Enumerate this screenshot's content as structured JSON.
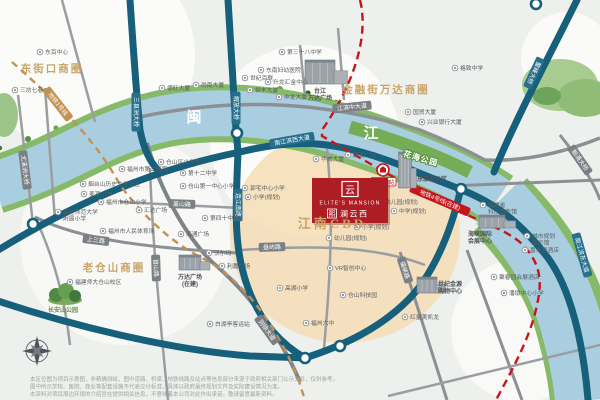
{
  "project": {
    "name_en": "ELITE'S MANSION",
    "prefix": "熙",
    "name_cn": "澜云西",
    "glyph": "云"
  },
  "metro": {
    "station": "江边村站"
  },
  "colors": {
    "logo_red": "#ae1d24",
    "gold_text": "#c9a468",
    "road_teal": "#16607c",
    "road_grey": "#7b8084",
    "river_blue": "#a9cee0",
    "metro_gold": "#c09355",
    "metro_red": "#c5161d",
    "planning_beige": "#f4ddb5"
  },
  "districts": [
    {
      "t": "东街口商圈",
      "x": 52,
      "y": 72,
      "s": 10.5,
      "c": "#c9a468",
      "ls": 2,
      "serif": 1
    },
    {
      "t": "金融街万达商圈",
      "x": 386,
      "y": 93,
      "s": 10.5,
      "c": "#c9a468",
      "ls": 2,
      "serif": 1
    },
    {
      "t": "老仓山商圈",
      "x": 114,
      "y": 271,
      "s": 10.5,
      "c": "#c9a468",
      "ls": 2,
      "serif": 1
    },
    {
      "t": "江南CBD",
      "x": 332,
      "y": 228,
      "s": 13,
      "c": "#c9a468",
      "ls": 3,
      "serif": 1
    },
    {
      "t": "闽",
      "x": 194,
      "y": 122,
      "s": 15,
      "c": "#ffffff",
      "ls": 0,
      "serif": 1
    },
    {
      "t": "江",
      "x": 371,
      "y": 138,
      "s": 15,
      "c": "#ffffff",
      "ls": 0,
      "serif": 1
    },
    {
      "t": "花海公园",
      "x": 420,
      "y": 161,
      "s": 8,
      "c": "#ffffff",
      "ls": 1,
      "rot": 16,
      "halo": "#58923f"
    },
    {
      "t": "长安山公园",
      "x": 63,
      "y": 312,
      "s": 6,
      "c": "#6a8f55",
      "ls": 0
    }
  ],
  "road_labels": [
    {
      "t": "南江滨西大道",
      "x": 292,
      "y": 140,
      "rot": -10,
      "type": "teal"
    },
    {
      "t": "江滨中大道",
      "x": 352,
      "y": 107,
      "rot": -6,
      "type": "grey"
    },
    {
      "t": "三县洲大桥",
      "x": 136,
      "y": 112,
      "rot": 90,
      "type": "teal"
    },
    {
      "t": "解放大桥",
      "x": 236,
      "y": 108,
      "rot": 90,
      "type": "teal"
    },
    {
      "t": "鳌峰大桥",
      "x": 534,
      "y": 73,
      "rot": 115,
      "type": "teal"
    },
    {
      "t": "魁浦大桥",
      "x": 580,
      "y": 160,
      "rot": 55,
      "type": "grey"
    },
    {
      "t": "南江滨东大道",
      "x": 582,
      "y": 255,
      "rot": 74,
      "type": "teal"
    },
    {
      "t": "连江南路",
      "x": 238,
      "y": 205,
      "rot": 90,
      "type": "teal"
    },
    {
      "t": "上三路",
      "x": 96,
      "y": 240,
      "rot": 7,
      "type": "grey"
    },
    {
      "t": "首山路",
      "x": 156,
      "y": 268,
      "rot": 88,
      "type": "grey"
    },
    {
      "t": "则徐大道",
      "x": 267,
      "y": 330,
      "rot": 54,
      "type": "grey"
    },
    {
      "t": "福峡路",
      "x": 405,
      "y": 270,
      "rot": 72,
      "type": "grey"
    },
    {
      "t": "盖山路",
      "x": 182,
      "y": 204,
      "rot": 2,
      "type": "grey"
    },
    {
      "t": "盘屿路",
      "x": 272,
      "y": 247,
      "rot": -2,
      "type": "grey"
    },
    {
      "t": "尤溪洲大桥",
      "x": 25,
      "y": 170,
      "rot": 83,
      "type": "grey"
    },
    {
      "t": "地铁1号线",
      "x": 58,
      "y": 104,
      "rot": 52,
      "type": "gold"
    },
    {
      "t": "地铁4号线(在建)",
      "x": 440,
      "y": 200,
      "rot": 23,
      "type": "red"
    }
  ],
  "buildings": [
    {
      "x": 320,
      "y": 84,
      "w": 30,
      "h": 24,
      "lx": 320,
      "ly": 93,
      "lines": [
        "台江",
        "万达广场"
      ]
    },
    {
      "x": 405,
      "y": 188,
      "w": 13,
      "h": 36,
      "lx": 432,
      "ly": 181,
      "lines": [
        "东部办公区"
      ]
    },
    {
      "x": 190,
      "y": 270,
      "w": 22,
      "h": 15,
      "lx": 190,
      "ly": 279,
      "lines": [
        "万达广场",
        "(在建)"
      ]
    },
    {
      "x": 427,
      "y": 293,
      "w": 20,
      "h": 16,
      "lx": 450,
      "ly": 286,
      "lines": [
        "世纪金源",
        "购物中心"
      ]
    },
    {
      "x": 492,
      "y": 228,
      "w": 26,
      "h": 13,
      "lx": 480,
      "ly": 236,
      "lines": [
        "海峡国际",
        "会展中心"
      ]
    }
  ],
  "pois": [
    {
      "x": 40,
      "y": 52,
      "lines": [
        "东百中心"
      ]
    },
    {
      "x": 15,
      "y": 90,
      "lines": [
        "三坊七巷"
      ]
    },
    {
      "x": 162,
      "y": 88,
      "lines": [
        "德旺大厦"
      ]
    },
    {
      "x": 196,
      "y": 85,
      "lines": [
        "尚南大厦"
      ]
    },
    {
      "x": 245,
      "y": 78,
      "lines": [
        "世纪百联"
      ]
    },
    {
      "x": 268,
      "y": 82,
      "lines": [
        "升龙汇金中心"
      ]
    },
    {
      "x": 250,
      "y": 90,
      "lines": [
        "恒丰大厦"
      ]
    },
    {
      "x": 279,
      "y": 97,
      "lines": [
        "申发大厦"
      ]
    },
    {
      "x": 261,
      "y": 70,
      "lines": [
        "东南妇幼医院"
      ]
    },
    {
      "x": 282,
      "y": 52,
      "lines": [
        "第三十八中学"
      ]
    },
    {
      "x": 455,
      "y": 68,
      "lines": [
        "格致中学"
      ]
    },
    {
      "x": 408,
      "y": 112,
      "lines": [
        "国贸大厦"
      ]
    },
    {
      "x": 422,
      "y": 122,
      "lines": [
        "兴业银行大厦"
      ]
    },
    {
      "x": 348,
      "y": 155,
      "lines": [
        "建发广场"
      ]
    },
    {
      "x": 316,
      "y": 159,
      "lines": [
        "华威大厦"
      ]
    },
    {
      "x": 380,
      "y": 202,
      "lines": [
        "幼儿园(规划)"
      ]
    },
    {
      "x": 394,
      "y": 211,
      "lines": [
        "中学(规划)"
      ]
    },
    {
      "x": 357,
      "y": 227,
      "lines": [
        "小学(规划)"
      ]
    },
    {
      "x": 329,
      "y": 238,
      "lines": [
        "幼儿园(规划)"
      ]
    },
    {
      "x": 245,
      "y": 188,
      "lines": [
        "郭宅中心小学"
      ]
    },
    {
      "x": 248,
      "y": 197,
      "lines": [
        "小学(规划)"
      ]
    },
    {
      "x": 161,
      "y": 162,
      "lines": [
        "仓山区少年宫"
      ]
    },
    {
      "x": 183,
      "y": 173,
      "lines": [
        "第十二中学"
      ]
    },
    {
      "x": 183,
      "y": 186,
      "lines": [
        "仓山第一中心小学"
      ]
    },
    {
      "x": 122,
      "y": 169,
      "lines": [
        "福州市第二医院"
      ]
    },
    {
      "x": 83,
      "y": 184,
      "lines": [
        "烟台山历史文化街区"
      ]
    },
    {
      "x": 84,
      "y": 194,
      "lines": [
        "麦顶小学"
      ]
    },
    {
      "x": 101,
      "y": 202,
      "lines": [
        "福州市仓山小学"
      ]
    },
    {
      "x": 58,
      "y": 212,
      "lines": [
        "福建师范大学",
        "附属小学"
      ]
    },
    {
      "x": 139,
      "y": 210,
      "lines": [
        "汇达广场"
      ]
    },
    {
      "x": 103,
      "y": 231,
      "lines": [
        "福州市人民体育场"
      ]
    },
    {
      "x": 181,
      "y": 234,
      "lines": [
        "海通广场"
      ]
    },
    {
      "x": 205,
      "y": 218,
      "lines": [
        "第四十中学"
      ]
    },
    {
      "x": 70,
      "y": 282,
      "lines": [
        "福建师大仓山校区"
      ]
    },
    {
      "x": 210,
      "y": 324,
      "lines": [
        "白湖亭客运站"
      ]
    },
    {
      "x": 209,
      "y": 253,
      "lines": [
        "沃尔玛"
      ]
    },
    {
      "x": 222,
      "y": 266,
      "lines": [
        "利嘉广场"
      ]
    },
    {
      "x": 280,
      "y": 288,
      "lines": [
        "高湖小学"
      ]
    },
    {
      "x": 330,
      "y": 268,
      "lines": [
        "VR智创中心"
      ]
    },
    {
      "x": 343,
      "y": 295,
      "lines": [
        "仓山科技园"
      ]
    },
    {
      "x": 306,
      "y": 323,
      "lines": [
        "福州六中"
      ]
    },
    {
      "x": 405,
      "y": 317,
      "lines": [
        "红星美凯龙"
      ]
    },
    {
      "x": 494,
      "y": 277,
      "lines": [
        "聚春园会展酒店"
      ]
    },
    {
      "x": 504,
      "y": 293,
      "lines": [
        "潘墩中心小学"
      ]
    },
    {
      "x": 483,
      "y": 205,
      "lines": [
        "福建省",
        "科技馆新馆"
      ]
    },
    {
      "x": 527,
      "y": 236,
      "lines": [
        "城市规划",
        "展示馆"
      ]
    },
    {
      "x": 525,
      "y": 250,
      "lines": [
        "喜来登酒店"
      ]
    }
  ],
  "disclaimer": {
    "line1": "本区位图为项目示意图，非精确测绘，图中道路、桥梁、地铁线路及站点等信息部分来源于政府相关部门公示文件，仅供参考。",
    "line2": "图中所示学校、医院、商业等配套设施不代表交付标准，具体以政府最终规划文件及实际建设情况为准。",
    "line3": "本资料对项目周边环境的介绍旨在提供相关信息，不意味着本公司对此作出承诺。敬请留意最新资料。"
  }
}
